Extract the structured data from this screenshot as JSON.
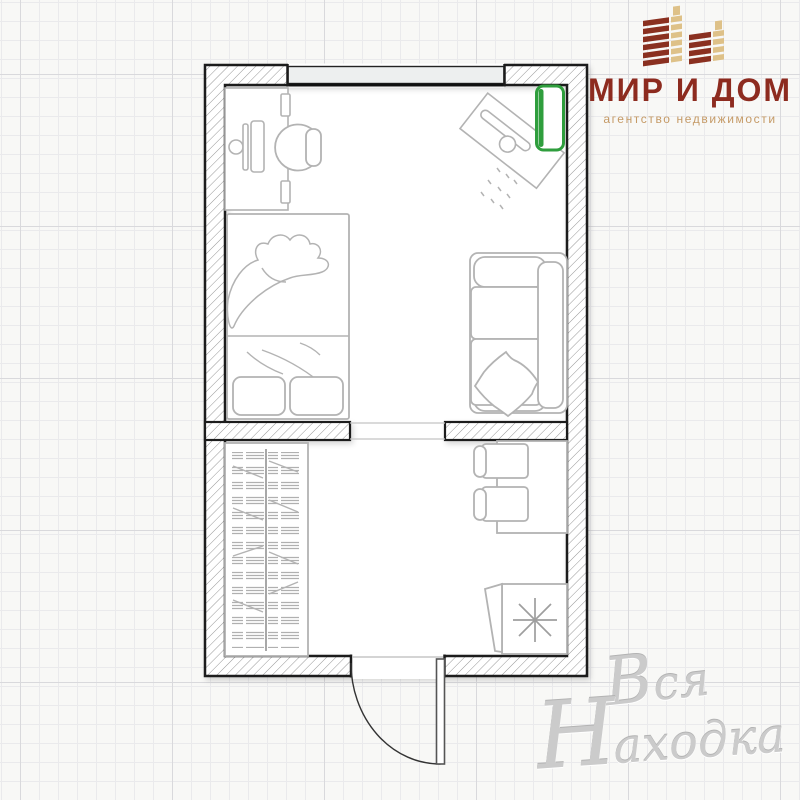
{
  "brand": {
    "title": "МИР И ДОМ",
    "subtitle": "агентство недвижимости",
    "colors": {
      "title": "#8d2b1f",
      "subtitle": "#c59a66",
      "building_dark": "#8a3020",
      "building_light": "#dec188"
    }
  },
  "watermark": {
    "word1": "Вся",
    "word2": "Находка",
    "color": "#cbcbcb"
  },
  "floorplan": {
    "type": "studio-apartment-plan",
    "wall_color": "#1b1b1b",
    "furniture_line_color": "#b3b3b3",
    "accent_green": "#2f9e3d",
    "rooms": [
      {
        "name": "living-room",
        "items": [
          "desk-with-computer",
          "office-chair",
          "ironing-board",
          "wall-mounted-heater",
          "bed",
          "sofa-with-pillow",
          "window"
        ]
      },
      {
        "name": "hall",
        "items": [
          "wardrobe-with-hangers",
          "dining-table",
          "two-chairs",
          "refrigerator",
          "entrance-door"
        ]
      }
    ]
  }
}
